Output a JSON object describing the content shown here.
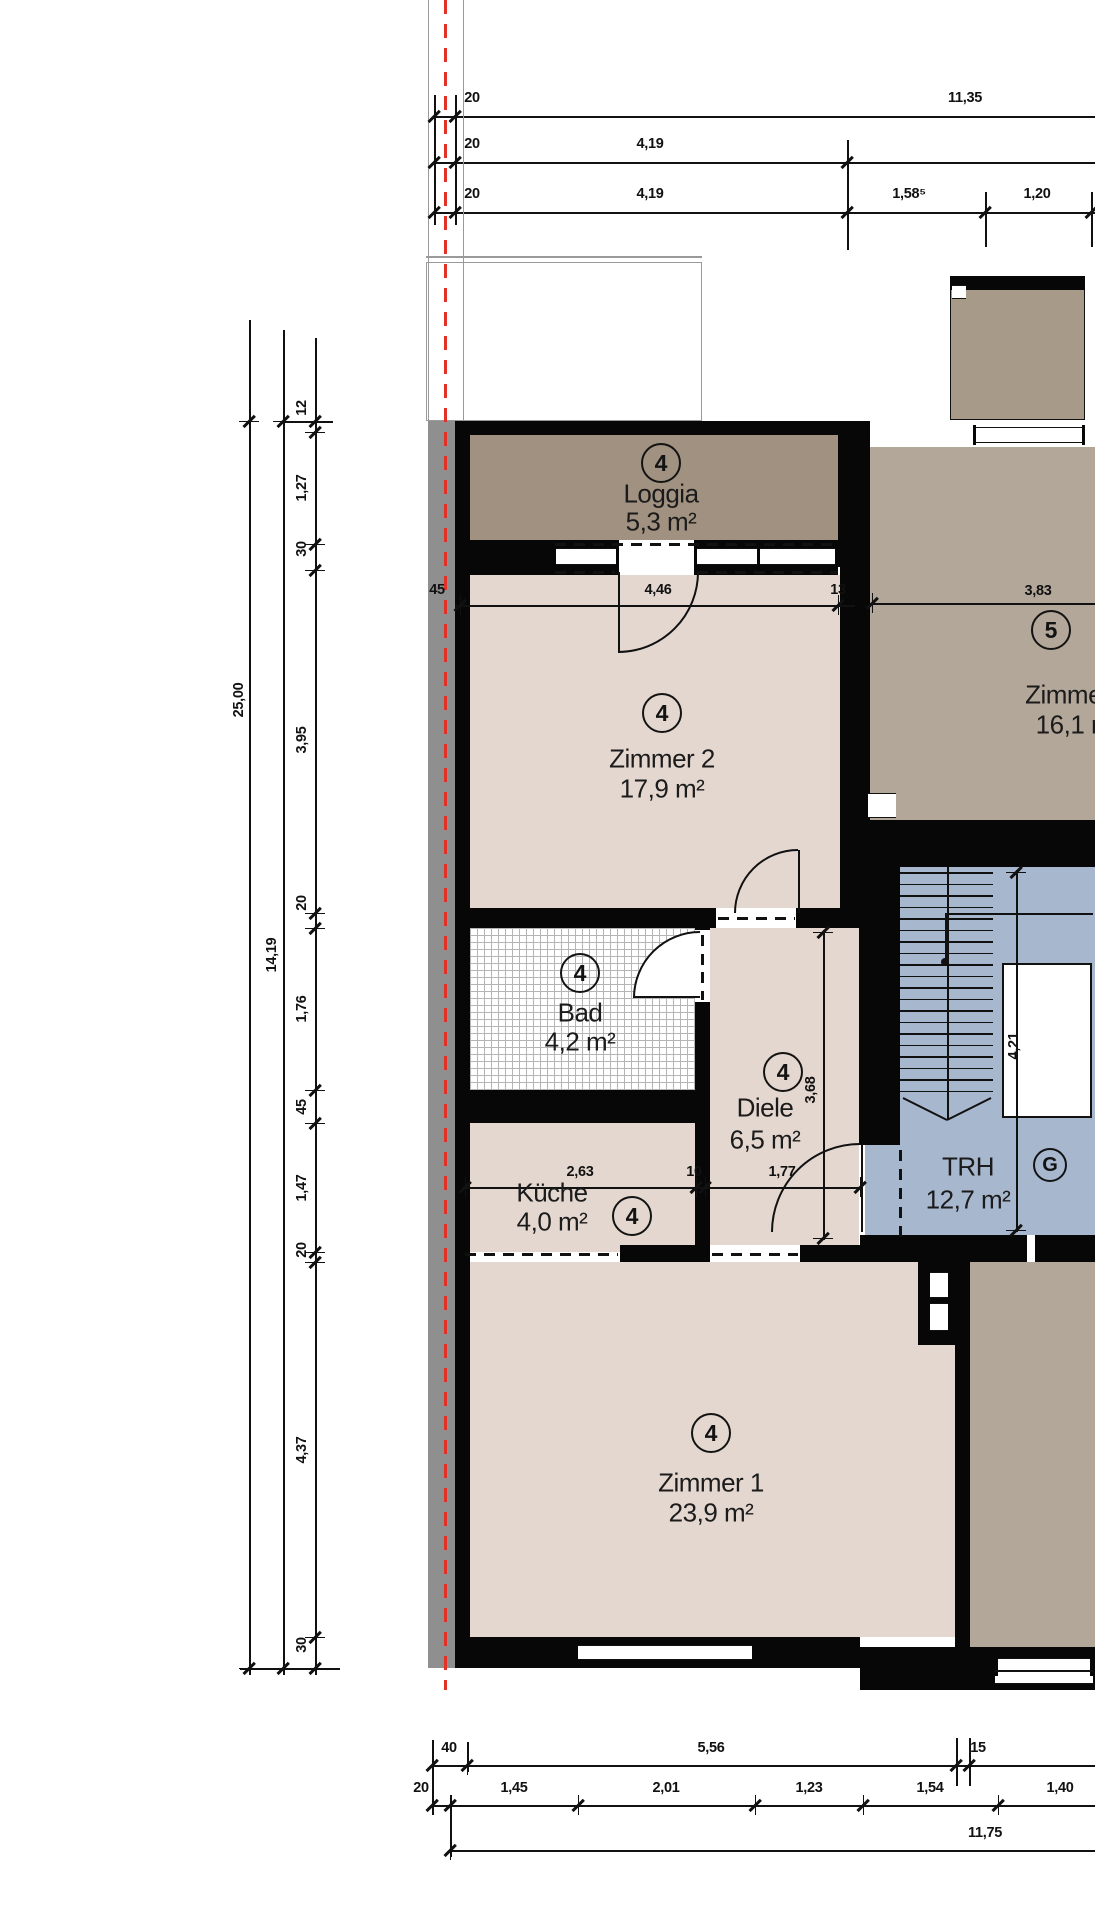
{
  "title": "Wohnungsgrundriss Obergeschoss",
  "palette": {
    "wall": "#070707",
    "line": "#111111",
    "pink": "#e4d7d0",
    "loggia": "#a09180",
    "tan": "#b3a79a",
    "balcony": "#a89a89",
    "blue": "#a7b7ce",
    "gray_band": "#8f8f8f",
    "red": "#e33127",
    "roof_line": "#9a9a9a",
    "text": "#1b1b1b"
  },
  "rooms": [
    {
      "id": "loggia",
      "tag": "4",
      "name": "Loggia",
      "area": "5,3 m²",
      "cx": 661,
      "tag_y": 463,
      "name_y": 494,
      "area_y": 522
    },
    {
      "id": "zimmer2",
      "tag": "4",
      "name": "Zimmer 2",
      "area": "17,9 m²",
      "cx": 662,
      "tag_y": 713,
      "name_y": 759,
      "area_y": 789
    },
    {
      "id": "zimmer3",
      "tag": "5",
      "name": "Zimmer 3",
      "area": "16,1 m²",
      "cx": 1078,
      "tag_x": 1051,
      "tag_y": 630,
      "name_y": 695,
      "area_y": 725
    },
    {
      "id": "bad",
      "tag": "4",
      "name": "Bad",
      "area": "4,2 m²",
      "cx": 580,
      "tag_y": 973,
      "name_y": 1013,
      "area_y": 1042
    },
    {
      "id": "kueche",
      "tag": "4",
      "name": "Küche",
      "area": "4,0 m²",
      "cx": 552,
      "tag_x": 632,
      "tag_y": 1216,
      "name_y": 1193,
      "area_y": 1222
    },
    {
      "id": "diele",
      "tag": "4",
      "name": "Diele",
      "area": "6,5 m²",
      "cx": 765,
      "tag_x": 783,
      "tag_y": 1072,
      "name_y": 1108,
      "area_y": 1140
    },
    {
      "id": "zimmer1",
      "tag": "4",
      "name": "Zimmer 1",
      "area": "23,9 m²",
      "cx": 711,
      "tag_y": 1433,
      "name_y": 1483,
      "area_y": 1513
    },
    {
      "id": "trh",
      "tag": "G",
      "name": "TRH",
      "area": "12,7 m²",
      "cx": 968,
      "tag_x": 1050,
      "tag_y": 1165,
      "name_y": 1167,
      "area_y": 1200
    }
  ],
  "dims": {
    "top": [
      {
        "v": "20",
        "x": 472,
        "y": 98
      },
      {
        "v": "11,35",
        "x": 965,
        "y": 98
      },
      {
        "v": "20",
        "x": 472,
        "y": 144
      },
      {
        "v": "4,19",
        "x": 650,
        "y": 144
      },
      {
        "v": "20",
        "x": 472,
        "y": 194
      },
      {
        "v": "4,19",
        "x": 650,
        "y": 194
      },
      {
        "v": "1,58⁵",
        "x": 909,
        "y": 194
      },
      {
        "v": "1,20",
        "x": 1037,
        "y": 194
      }
    ],
    "interior": [
      {
        "v": "45",
        "x": 437,
        "y": 590
      },
      {
        "v": "4,46",
        "x": 658,
        "y": 590
      },
      {
        "v": "13",
        "x": 838,
        "y": 590
      },
      {
        "v": "3,83",
        "x": 1038,
        "y": 591
      },
      {
        "v": "2,63",
        "x": 580,
        "y": 1172
      },
      {
        "v": "10",
        "x": 694,
        "y": 1172
      },
      {
        "v": "1,77",
        "x": 782,
        "y": 1172
      },
      {
        "v": "3,68",
        "x": 811,
        "y": 1090,
        "rot": 1
      },
      {
        "v": "4,21",
        "x": 1014,
        "y": 1046,
        "rot": 1
      }
    ],
    "left": [
      {
        "v": "25,00",
        "x": 239,
        "y": 700,
        "rot": 1
      },
      {
        "v": "14,19",
        "x": 272,
        "y": 955,
        "rot": 1
      },
      {
        "v": "12",
        "x": 302,
        "y": 408,
        "rot": 1
      },
      {
        "v": "1,27",
        "x": 302,
        "y": 488,
        "rot": 1
      },
      {
        "v": "30",
        "x": 302,
        "y": 549,
        "rot": 1
      },
      {
        "v": "3,95",
        "x": 302,
        "y": 740,
        "rot": 1
      },
      {
        "v": "20",
        "x": 302,
        "y": 903,
        "rot": 1
      },
      {
        "v": "1,76",
        "x": 302,
        "y": 1009,
        "rot": 1
      },
      {
        "v": "45",
        "x": 302,
        "y": 1107,
        "rot": 1
      },
      {
        "v": "1,47",
        "x": 302,
        "y": 1188,
        "rot": 1
      },
      {
        "v": "20",
        "x": 302,
        "y": 1250,
        "rot": 1
      },
      {
        "v": "4,37",
        "x": 302,
        "y": 1450,
        "rot": 1
      },
      {
        "v": "30",
        "x": 302,
        "y": 1645,
        "rot": 1
      }
    ],
    "bottom": [
      {
        "v": "40",
        "x": 449,
        "y": 1748
      },
      {
        "v": "5,56",
        "x": 711,
        "y": 1748
      },
      {
        "v": "15",
        "x": 978,
        "y": 1748
      },
      {
        "v": "20",
        "x": 421,
        "y": 1788
      },
      {
        "v": "1,45",
        "x": 514,
        "y": 1788
      },
      {
        "v": "2,01",
        "x": 666,
        "y": 1788
      },
      {
        "v": "1,23",
        "x": 809,
        "y": 1788
      },
      {
        "v": "1,54",
        "x": 930,
        "y": 1788
      },
      {
        "v": "1,40",
        "x": 1060,
        "y": 1788
      },
      {
        "v": "11,75",
        "x": 985,
        "y": 1833
      }
    ]
  },
  "geometry": {
    "fills": [
      {
        "x": 428,
        "y": 421,
        "w": 27,
        "h": 1247,
        "c": "gray_band",
        "n": "insulation-band"
      },
      {
        "x": 426,
        "y": 262,
        "w": 276,
        "h": 159,
        "c": "#ffffff",
        "b": "#9a9a9a",
        "n": "roof-outline"
      },
      {
        "x": 470,
        "y": 433,
        "w": 368,
        "h": 109,
        "c": "loggia",
        "n": "room-fill-loggia"
      },
      {
        "x": 470,
        "y": 575,
        "w": 370,
        "h": 333,
        "c": "pink",
        "n": "room-fill-zimmer2"
      },
      {
        "x": 870,
        "y": 447,
        "w": 225,
        "h": 373,
        "c": "tan",
        "n": "room-fill-zimmer3"
      },
      {
        "x": 950,
        "y": 283,
        "w": 135,
        "h": 137,
        "c": "balcony",
        "b": "#111111",
        "n": "balcony"
      },
      {
        "x": 470,
        "y": 925,
        "w": 225,
        "h": 165,
        "c": "hatch",
        "n": "room-fill-bad"
      },
      {
        "x": 470,
        "y": 1123,
        "w": 225,
        "h": 129,
        "c": "pink",
        "n": "room-fill-kueche"
      },
      {
        "x": 710,
        "y": 928,
        "w": 149,
        "h": 317,
        "c": "pink",
        "n": "room-fill-diele"
      },
      {
        "x": 470,
        "y": 1262,
        "w": 485,
        "h": 375,
        "c": "pink",
        "n": "room-fill-zimmer1"
      },
      {
        "x": 900,
        "y": 867,
        "w": 195,
        "h": 368,
        "c": "blue",
        "n": "room-fill-trh"
      },
      {
        "x": 865,
        "y": 1142,
        "w": 35,
        "h": 98,
        "c": "blue",
        "n": "entry-vestibule"
      },
      {
        "x": 970,
        "y": 1262,
        "w": 125,
        "h": 393,
        "c": "tan",
        "n": "room-fill-neighbor"
      }
    ],
    "walls": [
      {
        "x": 455,
        "y": 421,
        "w": 15,
        "h": 1247
      },
      {
        "x": 455,
        "y": 421,
        "w": 390,
        "h": 14
      },
      {
        "x": 838,
        "y": 421,
        "w": 32,
        "h": 146
      },
      {
        "x": 840,
        "y": 567,
        "w": 15,
        "h": 361
      },
      {
        "x": 855,
        "y": 421,
        "w": 15,
        "h": 446
      },
      {
        "x": 455,
        "y": 540,
        "w": 98,
        "h": 35
      },
      {
        "x": 553,
        "y": 540,
        "w": 285,
        "h": 35
      },
      {
        "x": 455,
        "y": 908,
        "w": 405,
        "h": 20
      },
      {
        "x": 695,
        "y": 925,
        "w": 15,
        "h": 337
      },
      {
        "x": 455,
        "y": 1090,
        "w": 255,
        "h": 33
      },
      {
        "x": 620,
        "y": 1245,
        "w": 90,
        "h": 17
      },
      {
        "x": 859,
        "y": 928,
        "w": 41,
        "h": 217
      },
      {
        "x": 800,
        "y": 1245,
        "w": 100,
        "h": 17
      },
      {
        "x": 855,
        "y": 820,
        "w": 240,
        "h": 47
      },
      {
        "x": 855,
        "y": 867,
        "w": 45,
        "h": 61
      },
      {
        "x": 860,
        "y": 1235,
        "w": 235,
        "h": 27
      },
      {
        "x": 955,
        "y": 1262,
        "w": 15,
        "h": 385
      },
      {
        "x": 918,
        "y": 1262,
        "w": 37,
        "h": 83
      },
      {
        "x": 455,
        "y": 1637,
        "w": 405,
        "h": 31
      },
      {
        "x": 860,
        "y": 1647,
        "w": 235,
        "h": 43
      },
      {
        "x": 950,
        "y": 276,
        "w": 135,
        "h": 14
      }
    ],
    "whites": [
      {
        "x": 553,
        "y": 548,
        "w": 285,
        "h": 17,
        "b": "b",
        "n": "loggia-window"
      },
      {
        "x": 616,
        "y": 540,
        "w": 81,
        "h": 35,
        "n": "loggia-door-gap"
      },
      {
        "x": 716,
        "y": 908,
        "w": 80,
        "h": 20,
        "n": "zimmer2-door-gap"
      },
      {
        "x": 695,
        "y": 930,
        "w": 15,
        "h": 72,
        "n": "bad-door-gap"
      },
      {
        "x": 634,
        "y": 932,
        "w": 66,
        "h": 66,
        "q": 1,
        "n": "bad-door-swing"
      },
      {
        "x": 973,
        "y": 427,
        "w": 112,
        "h": 16,
        "b": "b",
        "n": "zimmer3-window"
      },
      {
        "x": 575,
        "y": 1645,
        "w": 180,
        "h": 15,
        "b": "b",
        "n": "zimmer1-window"
      },
      {
        "x": 995,
        "y": 1658,
        "w": 98,
        "h": 26,
        "b": "b",
        "n": "neighbor-window"
      },
      {
        "x": 868,
        "y": 793,
        "w": 28,
        "h": 25,
        "b": "b",
        "n": "shaft-opening"
      },
      {
        "x": 930,
        "y": 1272,
        "w": 18,
        "h": 26,
        "b": "b",
        "n": "shaft-box-1"
      },
      {
        "x": 930,
        "y": 1303,
        "w": 18,
        "h": 28,
        "b": "b",
        "n": "shaft-box-2"
      },
      {
        "x": 1027,
        "y": 1235,
        "w": 8,
        "h": 27,
        "n": "trh-door-gap"
      },
      {
        "x": 952,
        "y": 285,
        "w": 14,
        "h": 14,
        "b": "b",
        "n": "balcony-corner"
      },
      {
        "x": 1002,
        "y": 963,
        "w": 90,
        "h": 155,
        "b": "b2",
        "n": "elevator-shaft"
      }
    ],
    "posts": [
      [
        616,
        540,
        3,
        35
      ],
      [
        694,
        540,
        3,
        35
      ],
      [
        553,
        545,
        3,
        22
      ],
      [
        835,
        545,
        3,
        22
      ],
      [
        757,
        547,
        3,
        18
      ],
      [
        973,
        425,
        3,
        20
      ],
      [
        1082,
        425,
        3,
        20
      ],
      [
        575,
        1643,
        3,
        19
      ],
      [
        752,
        1643,
        3,
        19
      ],
      [
        995,
        1656,
        3,
        20
      ],
      [
        1090,
        1656,
        3,
        20
      ]
    ],
    "lines": [
      {
        "x": 434,
        "y": 116,
        "l": 661,
        "o": "h"
      },
      {
        "x": 434,
        "y": 162,
        "l": 661,
        "o": "h"
      },
      {
        "x": 434,
        "y": 212,
        "l": 661,
        "o": "h"
      },
      {
        "x": 249,
        "y": 320,
        "l": 1355,
        "o": "v"
      },
      {
        "x": 283,
        "y": 330,
        "l": 1345,
        "o": "v"
      },
      {
        "x": 315,
        "y": 338,
        "l": 1337,
        "o": "v"
      },
      {
        "x": 455,
        "y": 605,
        "l": 400,
        "o": "h"
      },
      {
        "x": 870,
        "y": 603,
        "l": 225,
        "o": "h"
      },
      {
        "x": 465,
        "y": 1187,
        "l": 398,
        "o": "h"
      },
      {
        "x": 823,
        "y": 930,
        "l": 310,
        "o": "v"
      },
      {
        "x": 1016,
        "y": 870,
        "l": 362,
        "o": "v"
      },
      {
        "x": 432,
        "y": 1765,
        "l": 663,
        "o": "h"
      },
      {
        "x": 432,
        "y": 1805,
        "l": 663,
        "o": "h"
      },
      {
        "x": 450,
        "y": 1850,
        "l": 645,
        "o": "h"
      },
      {
        "x": 434,
        "y": 95,
        "l": 130,
        "o": "v"
      },
      {
        "x": 455,
        "y": 95,
        "l": 130,
        "o": "v"
      },
      {
        "x": 847,
        "y": 140,
        "l": 110,
        "o": "v"
      },
      {
        "x": 985,
        "y": 192,
        "l": 55,
        "o": "v"
      },
      {
        "x": 1091,
        "y": 192,
        "l": 55,
        "o": "v"
      },
      {
        "x": 432,
        "y": 1740,
        "l": 75,
        "o": "v"
      },
      {
        "x": 467,
        "y": 1742,
        "l": 30,
        "o": "v"
      },
      {
        "x": 956,
        "y": 1738,
        "l": 48,
        "o": "v"
      },
      {
        "x": 969,
        "y": 1738,
        "l": 48,
        "o": "v"
      },
      {
        "x": 450,
        "y": 1795,
        "l": 62,
        "o": "v"
      },
      {
        "x": 240,
        "y": 1668,
        "l": 100,
        "o": "h"
      },
      {
        "x": 283,
        "y": 421,
        "l": 50,
        "o": "h"
      },
      {
        "x": 945,
        "y": 913,
        "l": 49,
        "o": "v",
        "w": 2
      },
      {
        "x": 945,
        "y": 913,
        "l": 148,
        "o": "h",
        "w": 2
      },
      {
        "x": 947,
        "y": 867,
        "l": 253,
        "o": "v",
        "w": 2
      },
      {
        "x": 995,
        "y": 1670,
        "l": 98,
        "o": "h",
        "w": 1.5
      },
      {
        "x": 618,
        "y": 572,
        "l": 80,
        "o": "v",
        "w": 2
      },
      {
        "x": 798,
        "y": 850,
        "l": 63,
        "o": "v",
        "w": 2
      },
      {
        "x": 634,
        "y": 996,
        "l": 66,
        "o": "h",
        "w": 2
      },
      {
        "x": 861,
        "y": 1144,
        "l": 88,
        "o": "v",
        "w": 2
      },
      {
        "x": 428,
        "y": 0,
        "l": 421,
        "o": "v",
        "w": 1,
        "c": "#9a9a9a"
      },
      {
        "x": 463,
        "y": 0,
        "l": 421,
        "o": "v",
        "w": 1,
        "c": "#9a9a9a"
      },
      {
        "x": 426,
        "y": 256,
        "l": 276,
        "o": "h",
        "w": 1.5,
        "c": "#9a9a9a"
      }
    ],
    "dashes": [
      {
        "x": 555,
        "y": 543,
        "l": 283,
        "o": "h"
      },
      {
        "x": 555,
        "y": 571,
        "l": 60,
        "o": "h"
      },
      {
        "x": 697,
        "y": 571,
        "l": 141,
        "o": "h"
      },
      {
        "x": 718,
        "y": 917,
        "l": 77,
        "o": "h"
      },
      {
        "x": 701,
        "y": 935,
        "l": 30,
        "o": "v"
      },
      {
        "x": 701,
        "y": 972,
        "l": 28,
        "o": "v"
      },
      {
        "x": 465,
        "y": 1253,
        "l": 153,
        "o": "h"
      },
      {
        "x": 712,
        "y": 1253,
        "l": 86,
        "o": "h"
      },
      {
        "x": 899,
        "y": 1150,
        "l": 88,
        "o": "v"
      },
      {
        "x": 444,
        "y": 0,
        "l": 1690,
        "o": "v",
        "w": 3,
        "c": "red",
        "d": 14,
        "g": 10
      }
    ],
    "ticks": [
      {
        "x": 434,
        "y": 116
      },
      {
        "x": 455,
        "y": 116
      },
      {
        "x": 434,
        "y": 162
      },
      {
        "x": 455,
        "y": 162
      },
      {
        "x": 847,
        "y": 162
      },
      {
        "x": 434,
        "y": 212
      },
      {
        "x": 455,
        "y": 212
      },
      {
        "x": 847,
        "y": 212
      },
      {
        "x": 985,
        "y": 212
      },
      {
        "x": 1091,
        "y": 212
      },
      {
        "x": 460,
        "y": 605
      },
      {
        "x": 838,
        "y": 605
      },
      {
        "x": 872,
        "y": 603
      },
      {
        "x": 465,
        "y": 1187
      },
      {
        "x": 696,
        "y": 1187
      },
      {
        "x": 705,
        "y": 1187
      },
      {
        "x": 860,
        "y": 1187
      },
      {
        "x": 432,
        "y": 1765
      },
      {
        "x": 467,
        "y": 1765
      },
      {
        "x": 956,
        "y": 1765
      },
      {
        "x": 969,
        "y": 1765
      },
      {
        "x": 432,
        "y": 1805
      },
      {
        "x": 450,
        "y": 1805
      },
      {
        "x": 578,
        "y": 1805
      },
      {
        "x": 755,
        "y": 1805
      },
      {
        "x": 863,
        "y": 1805
      },
      {
        "x": 998,
        "y": 1805
      },
      {
        "x": 450,
        "y": 1850
      },
      {
        "x": 823,
        "y": 932,
        "o": "v"
      },
      {
        "x": 823,
        "y": 1238,
        "o": "v"
      },
      {
        "x": 1016,
        "y": 872,
        "o": "v"
      },
      {
        "x": 1016,
        "y": 1230,
        "o": "v"
      },
      {
        "x": 249,
        "y": 421,
        "o": "v"
      },
      {
        "x": 249,
        "y": 1668,
        "o": "v"
      },
      {
        "x": 283,
        "y": 421,
        "o": "v"
      },
      {
        "x": 283,
        "y": 1668,
        "o": "v"
      },
      {
        "x": 315,
        "y": 421,
        "o": "v"
      },
      {
        "x": 315,
        "y": 432,
        "o": "v"
      },
      {
        "x": 315,
        "y": 544,
        "o": "v"
      },
      {
        "x": 315,
        "y": 570,
        "o": "v"
      },
      {
        "x": 315,
        "y": 913,
        "o": "v"
      },
      {
        "x": 315,
        "y": 928,
        "o": "v"
      },
      {
        "x": 315,
        "y": 1090,
        "o": "v"
      },
      {
        "x": 315,
        "y": 1123,
        "o": "v"
      },
      {
        "x": 315,
        "y": 1252,
        "o": "v"
      },
      {
        "x": 315,
        "y": 1262,
        "o": "v"
      },
      {
        "x": 315,
        "y": 1637,
        "o": "v"
      },
      {
        "x": 315,
        "y": 1668,
        "o": "v"
      }
    ],
    "arcs": [
      "M698,572 A80,80 0 0 1 618,652",
      "M798,850 A63,63 0 0 0 735,913",
      "M634,998 A66,66 0 0 1 700,932",
      "M772,1232 A88,88 0 0 1 860,1144"
    ],
    "svg_lines": [
      [
        903,
        1098,
        947,
        1120
      ],
      [
        991,
        1098,
        947,
        1120
      ]
    ],
    "stairs": {
      "x": 900,
      "w": 93,
      "y0": 872,
      "step": 11.5,
      "n": 20
    },
    "dot": {
      "x": 945,
      "y": 962
    }
  }
}
